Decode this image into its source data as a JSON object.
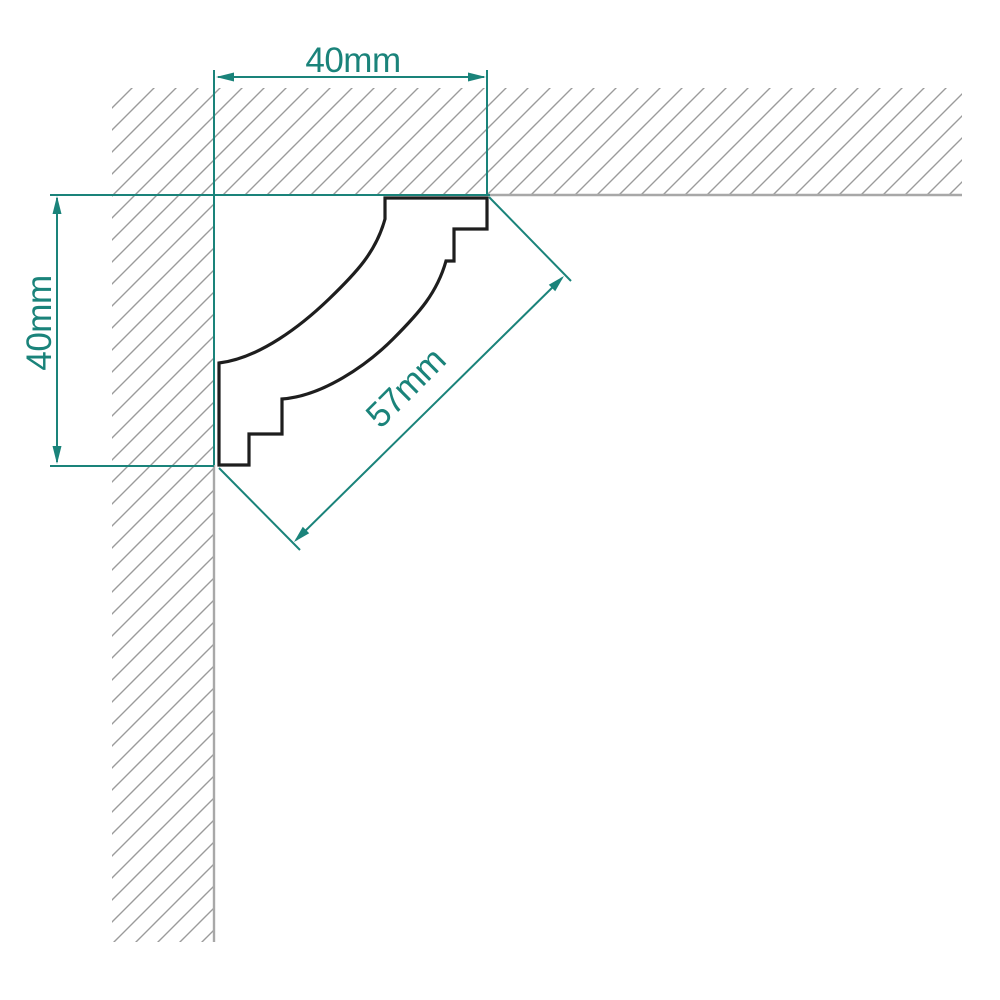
{
  "diagram": {
    "description": "cornice corner profile drawing",
    "dimensions": {
      "top": {
        "label": "40mm"
      },
      "left": {
        "label": "40mm"
      },
      "diagonal": {
        "label": "57mm"
      }
    },
    "colors": {
      "dimension_accent": "#1a837a",
      "hatch_line": "#9b9b9b",
      "surface_line": "#a8a8a8",
      "profile_outline": "#1e1e1e",
      "background": "#ffffff"
    }
  }
}
